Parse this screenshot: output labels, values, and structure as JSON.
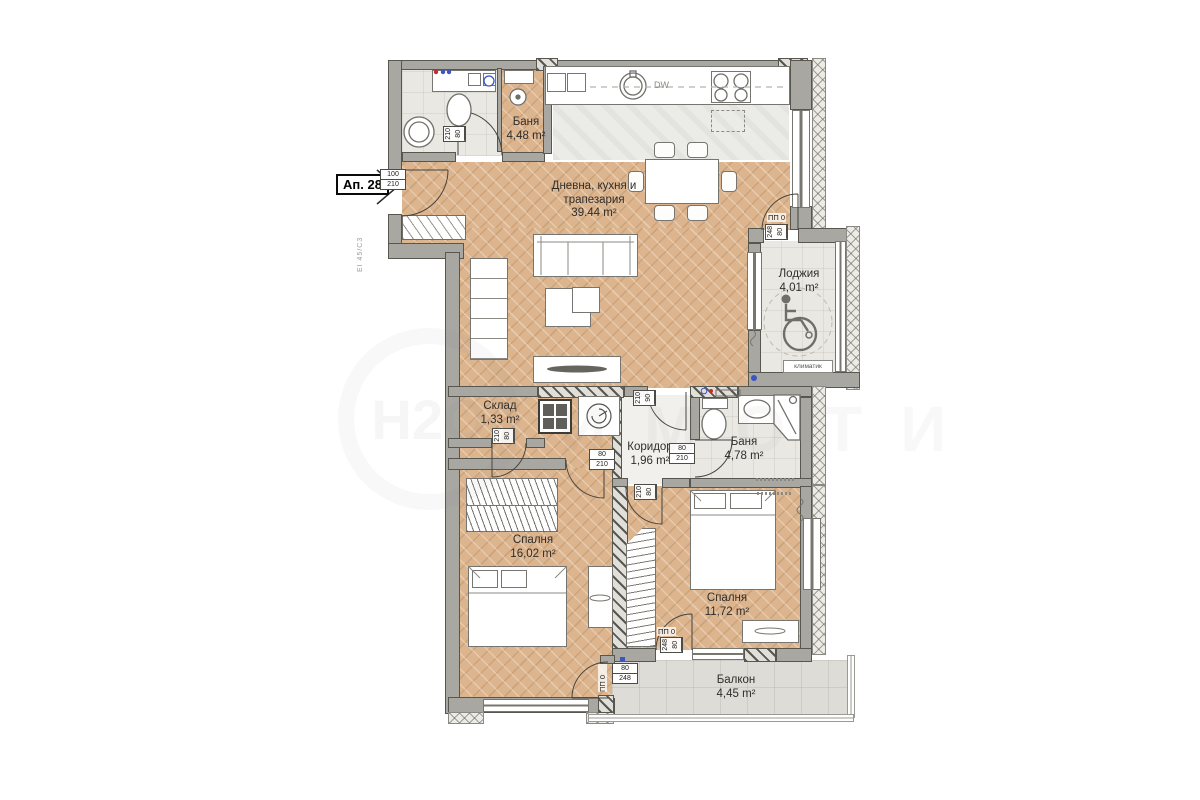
{
  "apartment": {
    "label": "Ап. 28",
    "entry_door_width": "100",
    "entry_door_height": "210",
    "fire_rating": "EI 45/C3"
  },
  "rooms": [
    {
      "name": "Баня",
      "area": "4,48 m²"
    },
    {
      "name": "Дневна, кухня и трапезария",
      "area": "39.44 m²"
    },
    {
      "name": "Лоджия",
      "area": "4,01 m²"
    },
    {
      "name": "Склад",
      "area": "1,33 m²"
    },
    {
      "name": "Коридор",
      "area": "1,96 m²"
    },
    {
      "name": "Баня",
      "area": "4,78 m²"
    },
    {
      "name": "Спалня",
      "area": "16,02 m²"
    },
    {
      "name": "Спалня",
      "area": "11,72 m²"
    },
    {
      "name": "Балкон",
      "area": "4,45 m²"
    }
  ],
  "doors": {
    "pp": "ПП 0",
    "w80": "80",
    "w90": "90",
    "w100": "100",
    "h210": "210",
    "h248": "248"
  },
  "appliances": {
    "dishwasher": "DW",
    "air_conditioner": "климатик"
  },
  "watermark": {
    "logo": "Н2О",
    "text": "ИМОТИ"
  },
  "colors": {
    "wood": "#dcb48d",
    "tile": "#e9e8e3",
    "wall": "#a8a7a2",
    "accent_red": "#cc2a2a",
    "accent_blue": "#3a55c4"
  }
}
